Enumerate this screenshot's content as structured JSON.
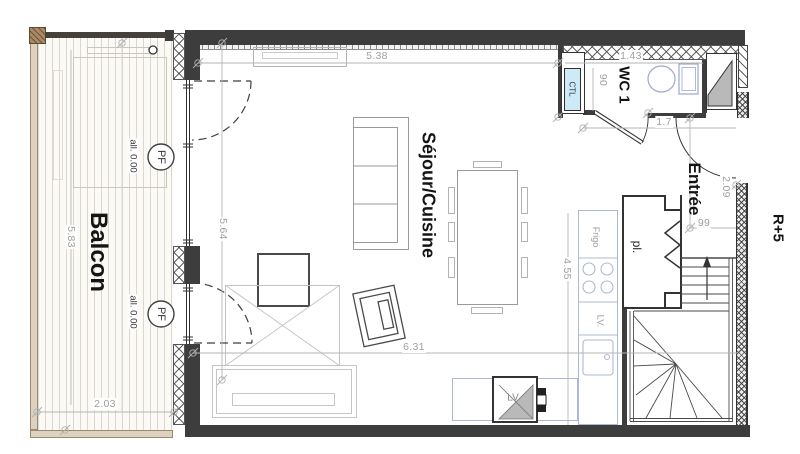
{
  "labels": {
    "balcony": "Balcon",
    "living": "Séjour/Cuisine",
    "wc": "WC 1",
    "entry": "Entrée",
    "closet": "pl.",
    "floor": "R+5",
    "window_tag": "PF",
    "sill": "all. 0.00",
    "duct": "CTL",
    "fridge": "Frigo",
    "dishwasher": "LV.",
    "appliance": "LV"
  },
  "dims": {
    "top_width": "5.38",
    "balcony_length": "5.83",
    "balcony_width": "2.03",
    "room_height": "5.64",
    "room_width": "6.31",
    "kitchen_run": "4.55",
    "wc_width": "1.43",
    "wc_depth": "90",
    "door_width": "1.7",
    "entry_depth": "2.09",
    "hall_width": "99"
  },
  "colors": {
    "wall": "#3d3d3d",
    "fixture_outline": "#adb8d6",
    "duct_fill": "#cdeaf6",
    "dimension_text": "#9f9f9f",
    "deck_frame": "#9b8a70",
    "label_text": "#141414"
  }
}
